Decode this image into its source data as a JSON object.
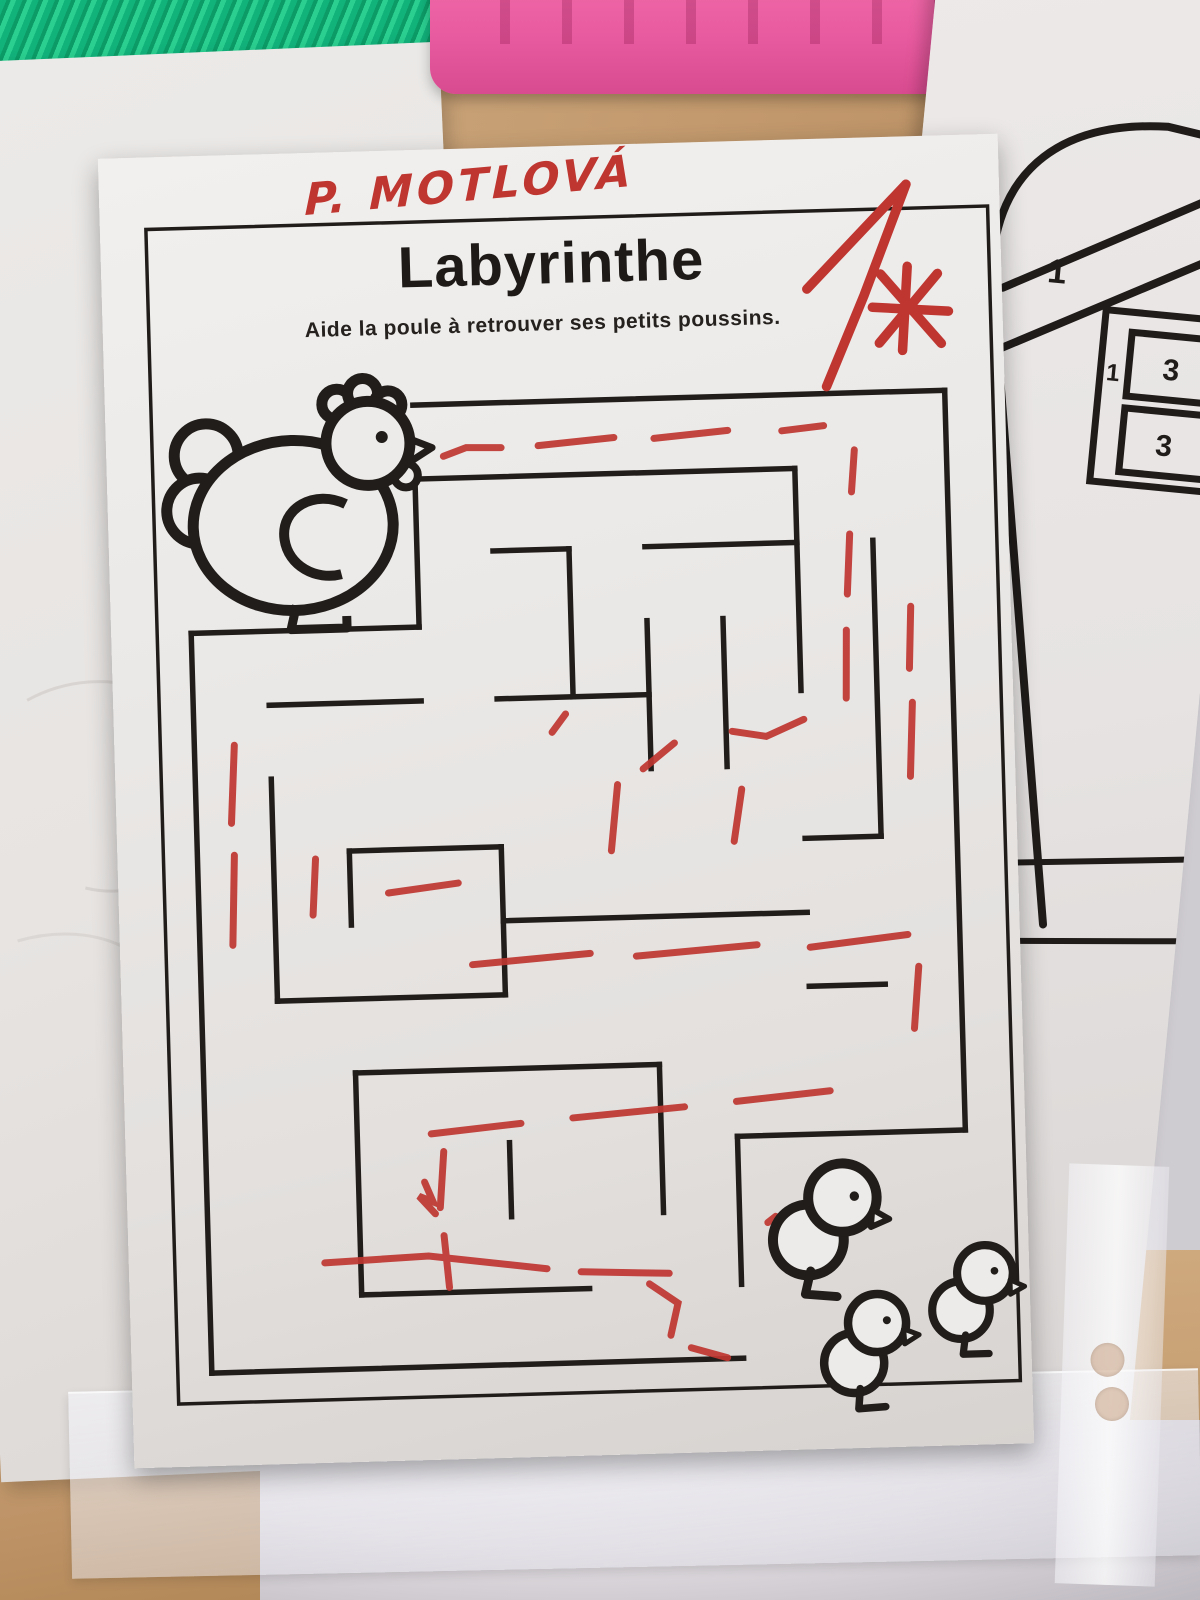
{
  "worksheet": {
    "student_name": "P. MOTLOVÁ",
    "title": "Labyrinthe",
    "subtitle": "Aide la poule à retrouver ses petits poussins.",
    "grade_value": "1"
  },
  "template_paper": {
    "big_one": "1",
    "small_one": "1",
    "square_top": "3",
    "square_bottom": "3",
    "letter": "á"
  },
  "colors": {
    "ink": "#201d1a",
    "red_pen": "#bf3631",
    "paper": "#ecc",
    "paper_fill": "#edebe9",
    "desk_wood": "#c49e74",
    "green_fabric": "#12b27b",
    "pink_case": "#e85a9f"
  },
  "maze": {
    "grid": {
      "x0": 80,
      "y0": 255,
      "cx": 76,
      "cy": 74
    },
    "walls": [
      [
        3,
        0,
        10,
        0
      ],
      [
        10,
        0,
        10,
        10
      ],
      [
        0,
        3,
        0,
        13
      ],
      [
        0,
        13,
        7,
        13
      ],
      [
        3,
        1,
        3,
        3
      ],
      [
        0,
        3,
        3,
        3
      ],
      [
        3,
        1,
        8,
        1
      ],
      [
        8,
        1,
        8,
        4
      ],
      [
        4,
        2,
        5,
        2
      ],
      [
        6,
        2,
        8,
        2
      ],
      [
        5,
        2,
        5,
        4
      ],
      [
        6,
        3,
        6,
        5
      ],
      [
        7,
        3,
        7,
        5
      ],
      [
        9,
        2,
        9,
        6
      ],
      [
        8,
        6,
        9,
        6
      ],
      [
        1,
        4,
        3,
        4
      ],
      [
        4,
        4,
        6,
        4
      ],
      [
        1,
        5,
        1,
        8
      ],
      [
        1,
        8,
        4,
        8
      ],
      [
        4,
        6,
        4,
        8
      ],
      [
        2,
        6,
        4,
        6
      ],
      [
        2,
        6,
        2,
        7
      ],
      [
        4,
        7,
        8,
        7
      ],
      [
        8,
        8,
        9,
        8
      ],
      [
        2,
        9,
        6,
        9
      ],
      [
        2,
        9,
        2,
        12
      ],
      [
        2,
        12,
        5,
        12
      ],
      [
        4,
        10,
        4,
        11
      ],
      [
        6,
        9,
        6,
        11
      ],
      [
        7,
        10,
        10,
        10
      ],
      [
        7,
        10,
        7,
        12
      ]
    ],
    "red_segments": [
      [
        [
          337,
          307
        ],
        [
          360,
          299
        ],
        [
          395,
          300
        ]
      ],
      [
        [
          432,
          299
        ],
        [
          508,
          293
        ]
      ],
      [
        [
          548,
          295
        ],
        [
          622,
          289
        ]
      ],
      [
        [
          676,
          291
        ],
        [
          718,
          287
        ]
      ],
      [
        [
          748,
          312
        ],
        [
          744,
          354
        ]
      ],
      [
        [
          741,
          396
        ],
        [
          737,
          456
        ]
      ],
      [
        [
          735,
          492
        ],
        [
          733,
          560
        ]
      ],
      [
        [
          800,
          470
        ],
        [
          797,
          532
        ]
      ],
      [
        [
          799,
          566
        ],
        [
          795,
          640
        ]
      ],
      [
        [
          690,
          580
        ],
        [
          652,
          596
        ],
        [
          618,
          590
        ]
      ],
      [
        [
          560,
          600
        ],
        [
          528,
          625
        ]
      ],
      [
        [
          502,
          640
        ],
        [
          494,
          706
        ]
      ],
      [
        [
          626,
          648
        ],
        [
          617,
          700
        ]
      ],
      [
        [
          452,
          568
        ],
        [
          438,
          586
        ]
      ],
      [
        [
          120,
          590
        ],
        [
          115,
          668
        ]
      ],
      [
        [
          117,
          700
        ],
        [
          113,
          790
        ]
      ],
      [
        [
          198,
          706
        ],
        [
          194,
          762
        ]
      ],
      [
        [
          270,
          742
        ],
        [
          340,
          734
        ]
      ],
      [
        [
          352,
          816
        ],
        [
          470,
          808
        ]
      ],
      [
        [
          516,
          812
        ],
        [
          637,
          804
        ]
      ],
      [
        [
          690,
          808
        ],
        [
          788,
          798
        ]
      ],
      [
        [
          798,
          830
        ],
        [
          792,
          892
        ]
      ],
      [
        [
          706,
          952
        ],
        [
          612,
          960
        ]
      ],
      [
        [
          560,
          964
        ],
        [
          448,
          972
        ]
      ],
      [
        [
          396,
          976
        ],
        [
          306,
          984
        ]
      ],
      [
        [
          318,
          1002
        ],
        [
          313,
          1058
        ]
      ],
      [
        [
          316,
          1086
        ],
        [
          320,
          1138
        ]
      ],
      [
        [
          298,
          1032
        ],
        [
          306,
          1052
        ],
        [
          292,
          1046
        ],
        [
          308,
          1064
        ]
      ],
      [
        [
          196,
          1110
        ],
        [
          300,
          1106
        ],
        [
          418,
          1122
        ]
      ],
      [
        [
          452,
          1126
        ],
        [
          540,
          1130
        ]
      ],
      [
        [
          520,
          1140
        ],
        [
          548,
          1160
        ],
        [
          540,
          1192
        ]
      ],
      [
        [
          560,
          1205
        ],
        [
          596,
          1216
        ]
      ],
      [
        [
          648,
          1076
        ],
        [
          640,
          1082
        ]
      ]
    ],
    "grade_strokes": [
      [
        [
          705,
          150
        ],
        [
          807,
          48
        ]
      ],
      [
        [
          807,
          48
        ],
        [
          762,
          158
        ],
        [
          722,
          248
        ]
      ],
      [
        [
          770,
          170
        ],
        [
          846,
          176
        ]
      ],
      [
        [
          806,
          130
        ],
        [
          799,
          214
        ]
      ],
      [
        [
          836,
          138
        ],
        [
          776,
          206
        ]
      ],
      [
        [
          779,
          137
        ],
        [
          838,
          208
        ]
      ]
    ],
    "chicks": [
      {
        "x": 702,
        "y": 1072,
        "s": 1.18,
        "r": 6
      },
      {
        "x": 737,
        "y": 1198,
        "s": 1.0,
        "r": -3
      },
      {
        "x": 846,
        "y": 1150,
        "s": 0.96,
        "r": 0
      }
    ]
  }
}
